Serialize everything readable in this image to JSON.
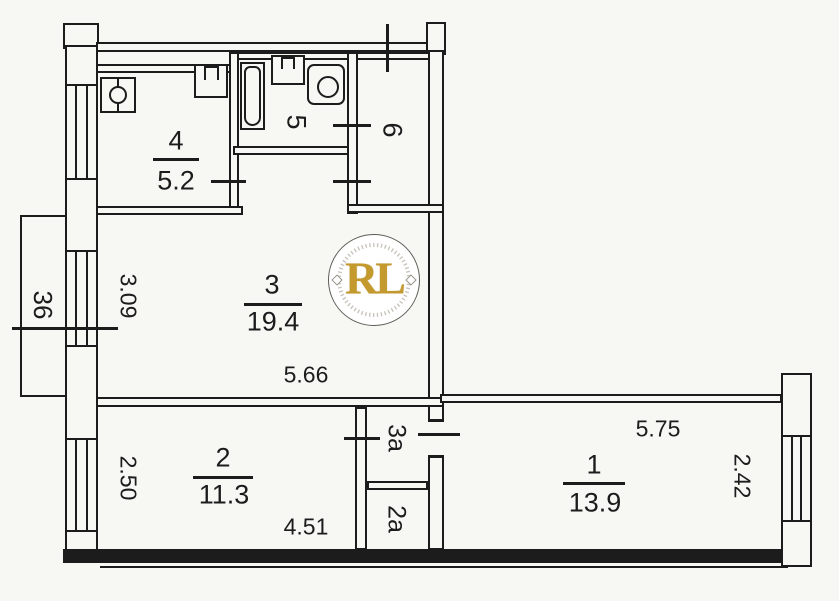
{
  "plan_title": "apartment-floor-plan",
  "colors": {
    "ink": "#1c1c1c",
    "paper": "#f7f7f4",
    "watermark_gold": "#c49a2f"
  },
  "watermark": {
    "letters": "RL"
  },
  "rooms": {
    "r1": {
      "number": "1",
      "area": "13.9"
    },
    "r2": {
      "number": "2",
      "area": "11.3"
    },
    "r3": {
      "number": "3",
      "area": "19.4"
    },
    "r4": {
      "number": "4",
      "area": "5.2"
    },
    "r5": {
      "number": "5"
    },
    "r6": {
      "number": "6"
    },
    "r3a": {
      "number": "3a"
    },
    "r2a": {
      "number": "2a"
    },
    "balcony": {
      "number": "36"
    }
  },
  "dimensions": {
    "room3_width": "5.66",
    "room3_height": "3.09",
    "room2_width": "4.51",
    "room2_height": "2.50",
    "room1_width": "5.75",
    "room1_height": "2.42"
  }
}
